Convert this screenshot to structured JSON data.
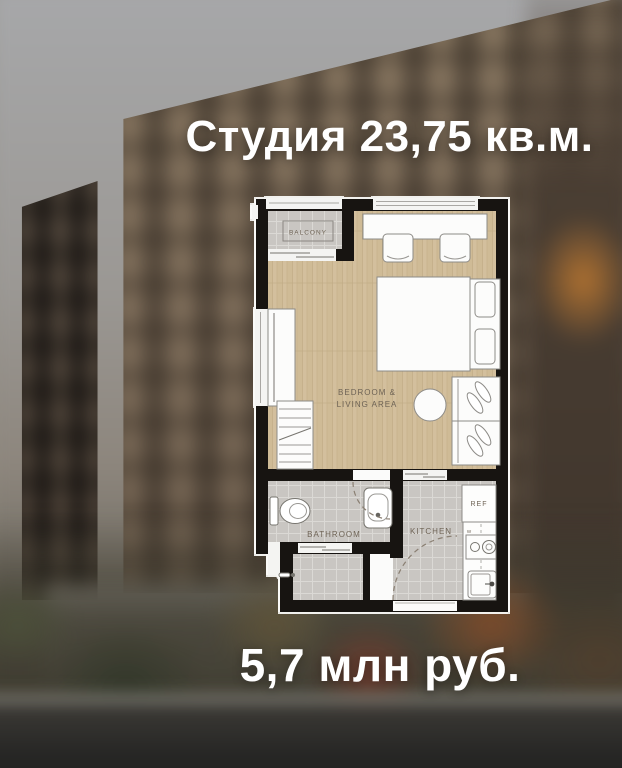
{
  "header": {
    "title": "Студия 23,75 кв.м."
  },
  "footer": {
    "price": "5,7 млн руб."
  },
  "plan": {
    "balcony_label": "BALCONY",
    "main_label_line1": "BEDROOM &",
    "main_label_line2": "LIVING AREA",
    "bathroom_label": "BATHROOM",
    "kitchen_label": "KITCHEN",
    "fridge_label": "REF",
    "washer_label": "W"
  },
  "colors": {
    "wall": "#171411",
    "wood_floor": "#cfbb96",
    "tile_floor": "#c9c6c2",
    "headline_text": "#ffffff",
    "plan_label_text": "#6e6355"
  }
}
